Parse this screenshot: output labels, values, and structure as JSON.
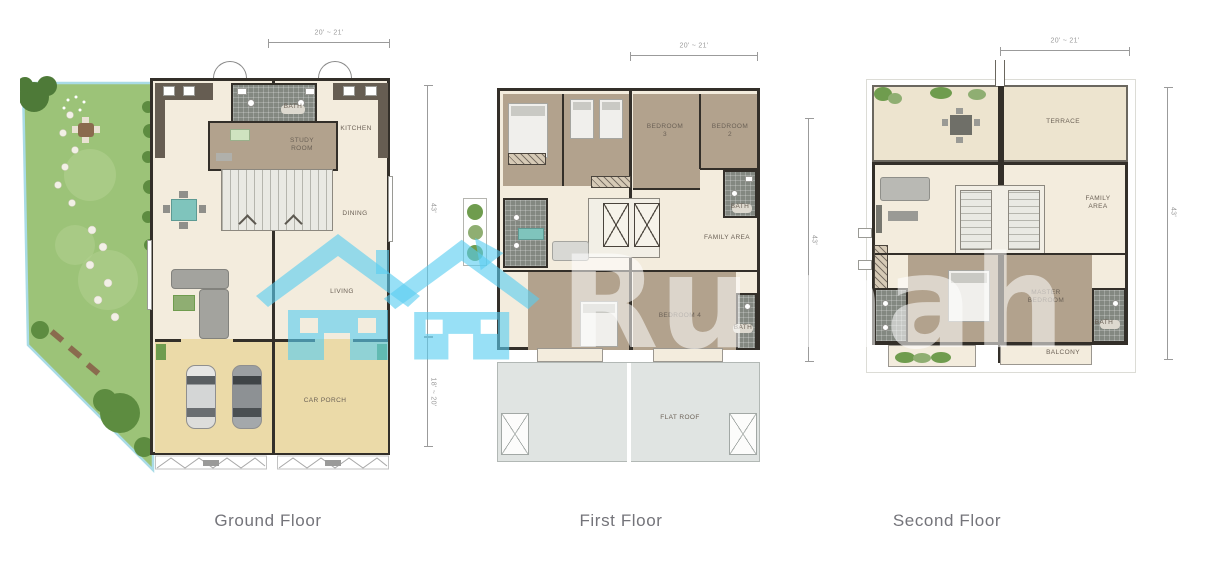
{
  "watermark": {
    "brand": "Rumah"
  },
  "plans": {
    "ground": {
      "title": "Ground Floor",
      "dims": {
        "top": "20' ~ 21'",
        "right_upper": "43'",
        "right_lower": "18' ~ 20'"
      },
      "labels": {
        "bath": "BATH",
        "study_room": "STUDY ROOM",
        "kitchen": "KITCHEN",
        "dining": "DINING",
        "living": "LIVING",
        "car_porch": "CAR PORCH"
      }
    },
    "first": {
      "title": "First Floor",
      "dims": {
        "top": "20' ~ 21'",
        "right": "43'"
      },
      "labels": {
        "bedroom3": "BEDROOM 3",
        "bedroom2": "BEDROOM 2",
        "bath_upper": "BATH",
        "family_area": "FAMILY AREA",
        "bedroom4": "BEDROOM 4",
        "bath_lower": "BATH",
        "flat_roof": "FLAT ROOF"
      }
    },
    "second": {
      "title": "Second Floor",
      "dims": {
        "top": "20' ~ 21'",
        "right": "43'"
      },
      "labels": {
        "terrace": "TERRACE",
        "family_area": "FAMILY AREA",
        "master_bedroom": "MASTER BEDROOM",
        "bath": "BATH",
        "balcony": "BALCONY"
      }
    }
  },
  "colors": {
    "wall": "#332f29",
    "cream": "#f3ecdd",
    "taupe": "#b2a28d",
    "tile": "#838881",
    "porch": "#ebdaa8",
    "garden": "#9cc378",
    "garden_dark": "#5d8c40",
    "roof": "#e0e4e2",
    "terrace": "#ede4cf",
    "teal": "#59cdf0",
    "boundary": "#a9dbe6",
    "dim": "#9b9b9b",
    "label": "#6b6156",
    "title": "#74747a"
  }
}
